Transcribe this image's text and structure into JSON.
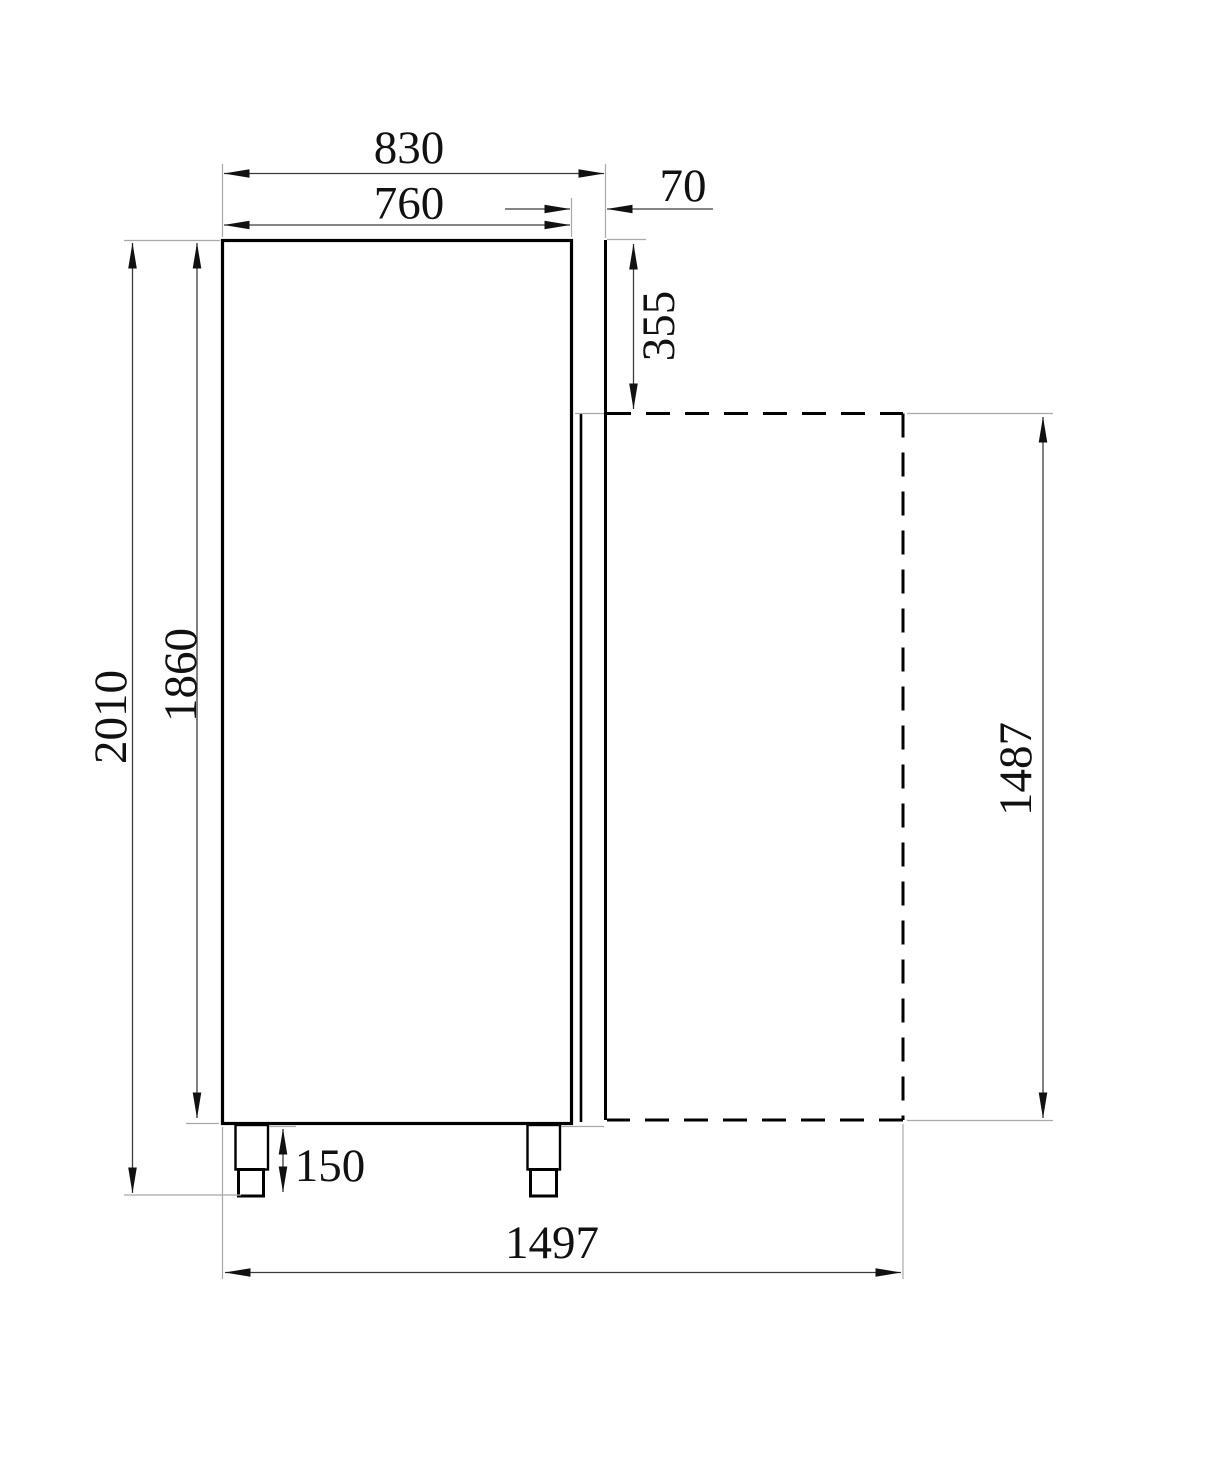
{
  "dimensions": {
    "top_width": "830",
    "top_inner_width": "760",
    "door_thickness": "70",
    "upper_right_offset": "355",
    "left_outer_height": "2010",
    "left_inner_height": "1860",
    "foot_height": "150",
    "bottom_width": "1497",
    "right_height": "1487"
  }
}
